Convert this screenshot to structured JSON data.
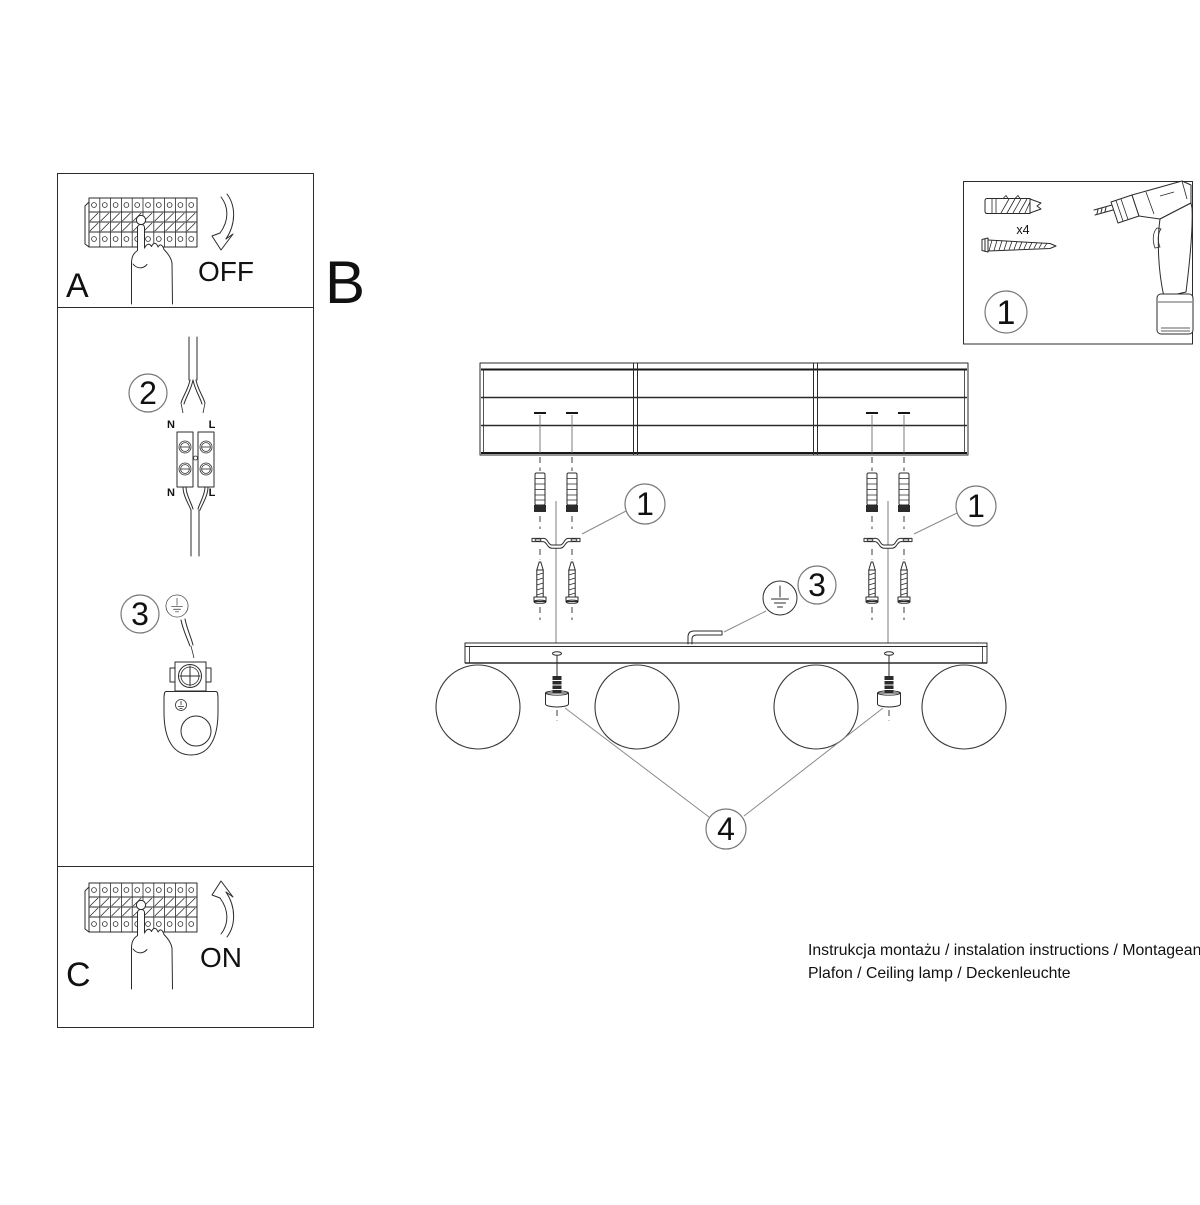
{
  "colors": {
    "line": "#2b2b2b",
    "leader": "#8a8a8a",
    "paper": "#ffffff"
  },
  "panel_a": {
    "label": "A",
    "action": "OFF"
  },
  "panel_c": {
    "label": "C",
    "action": "ON"
  },
  "section_b_label": "B",
  "step2": {
    "number": "2",
    "top_left": "N",
    "top_right": "L",
    "bottom_left": "N",
    "bottom_right": "L"
  },
  "step3": {
    "number": "3"
  },
  "tools": {
    "number": "1",
    "anchor_count": "x4"
  },
  "main": {
    "bracket_left": "1",
    "bracket_right": "1",
    "ground": "3",
    "shades": "4"
  },
  "footer": {
    "line1": "Instrukcja montażu / instalation instructions / Montageanleitung",
    "line2": "Plafon / Ceiling lamp / Deckenleuchte"
  }
}
